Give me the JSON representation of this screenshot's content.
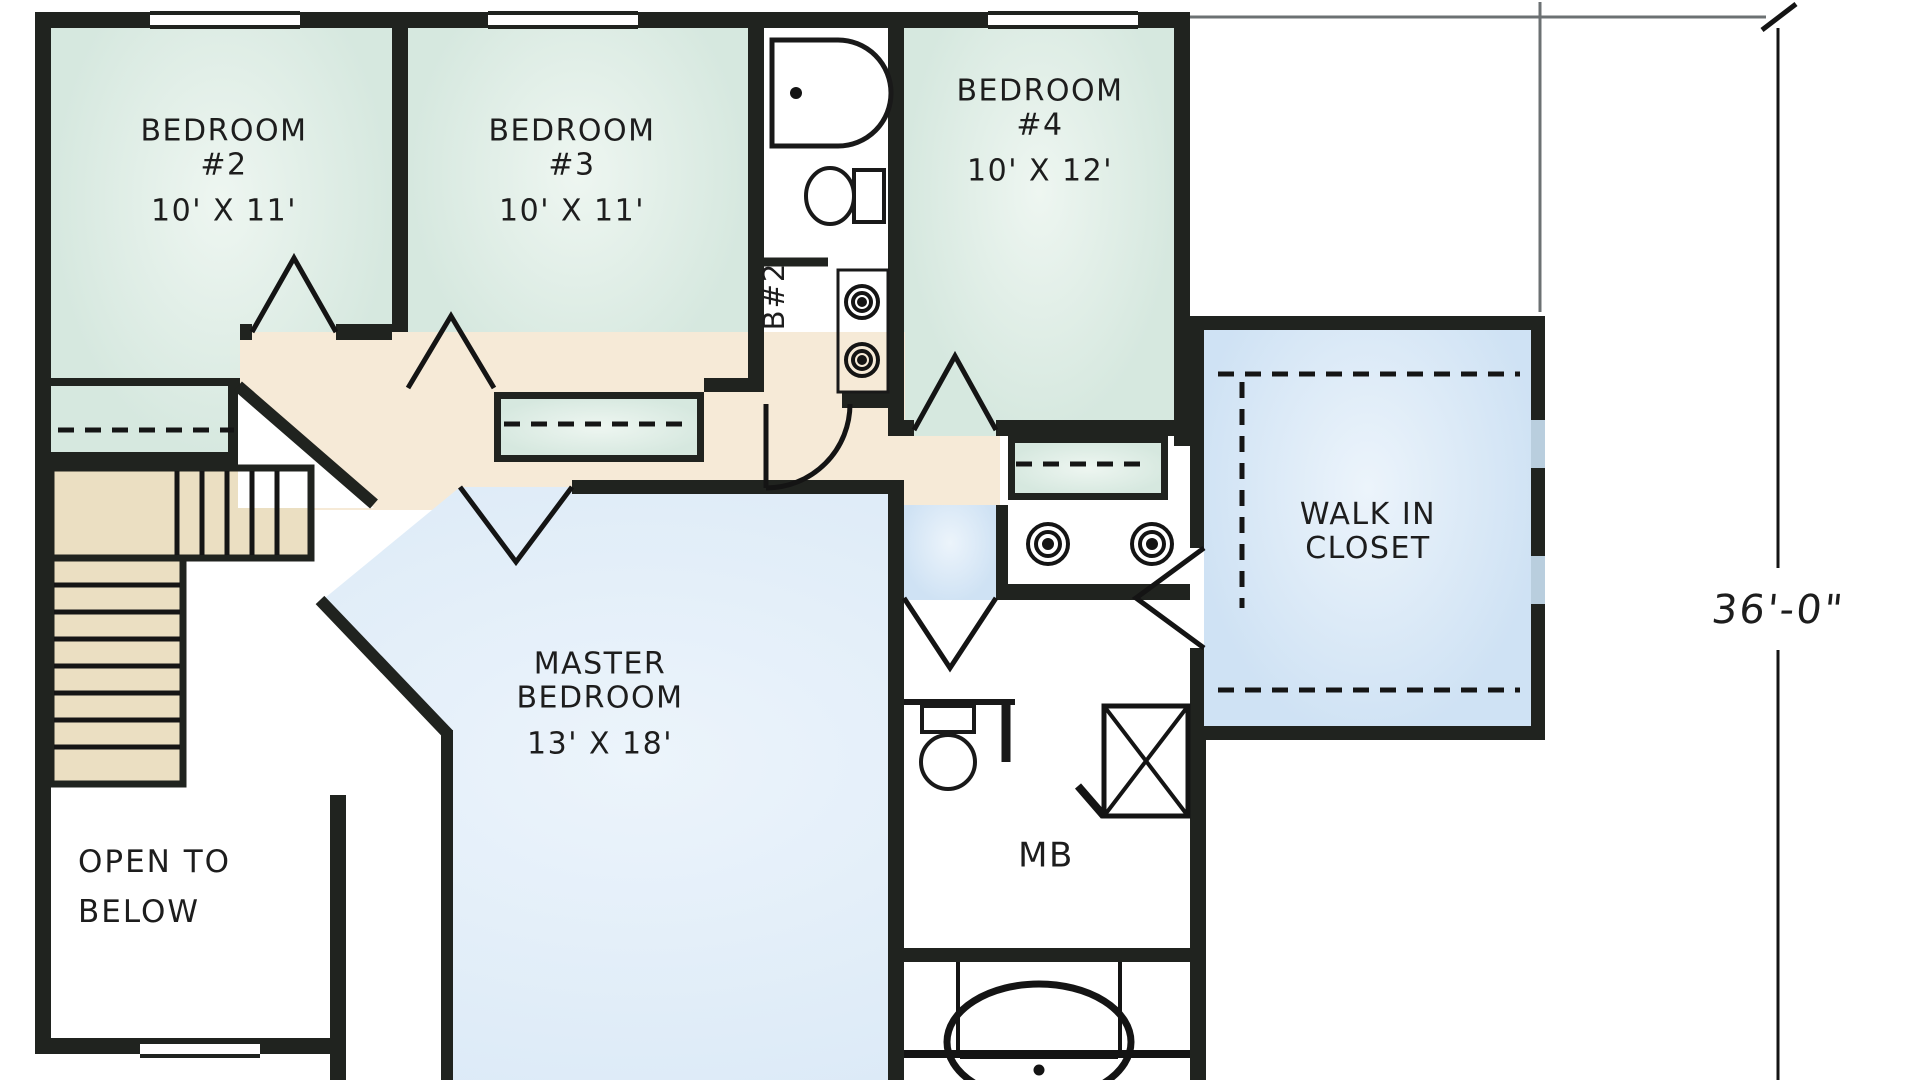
{
  "title": "Second Floor Plan",
  "dimension": {
    "label": "36'-0\""
  },
  "rooms": {
    "bedroom2": {
      "line1": "BEDROOM",
      "line2": "#2",
      "dims": "10' X 11'"
    },
    "bedroom3": {
      "line1": "BEDROOM",
      "line2": "#3",
      "dims": "10' X 11'"
    },
    "bedroom4": {
      "line1": "BEDROOM",
      "line2": "#4",
      "dims": "10' X 12'"
    },
    "master": {
      "line1": "MASTER",
      "line2": "BEDROOM",
      "dims": "13' X 18'"
    },
    "walk_in_closet": {
      "line1": "WALK IN",
      "line2": "CLOSET"
    },
    "master_bath": {
      "label": "MB"
    },
    "bath2": {
      "label": "B#2"
    },
    "open_to_below": {
      "line1": "OPEN TO",
      "line2": "BELOW"
    }
  },
  "colors": {
    "bedroom_green": "#d6e8df",
    "bedroom_green_light": "#eef6f1",
    "master_blue": "#cfe2f4",
    "master_blue_light": "#ecf4fb",
    "hall_cream": "#f6ead7",
    "stair_tan": "#ebdfc2",
    "wall": "#20231f",
    "line_gray": "#6c7173"
  }
}
